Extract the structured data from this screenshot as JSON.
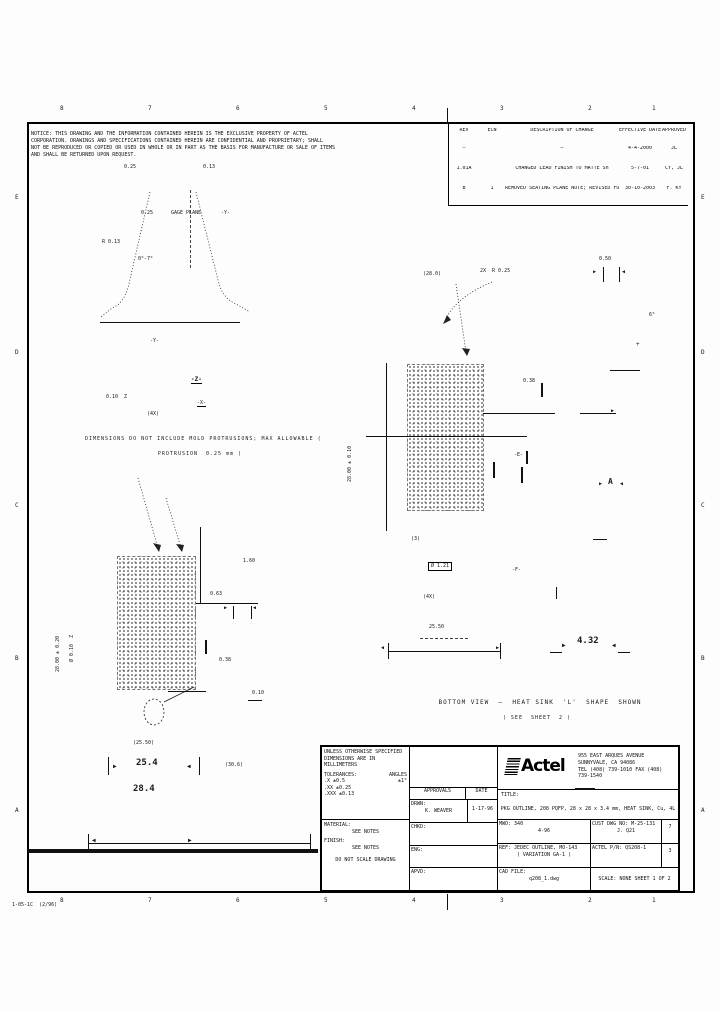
{
  "doc_number": "1-05-1C  (2/96)",
  "notes": {
    "lines": [
      "NOTICE: THIS DRAWING AND THE INFORMATION CONTAINED HEREIN IS THE EXCLUSIVE PROPERTY OF ACTEL",
      "CORPORATION. DRAWINGS AND SPECIFICATIONS CONTAINED HEREIN ARE CONFIDENTIAL AND PROPRIETARY; SHALL",
      "NOT BE REPRODUCED OR COPIED OR USED IN WHOLE OR IN PART AS THE BASIS FOR MANUFACTURE OR SALE OF ITEMS",
      "AND SHALL BE RETURNED UPON REQUEST."
    ]
  },
  "rev_table": {
    "headers": [
      "REV",
      "ECN",
      "DESCRIPTION OF CHANGE",
      "EFFECTIVE DATE",
      "APPROVED"
    ],
    "rows": [
      {
        "rev": "—",
        "ecn": "",
        "desc": "—",
        "date": "4-4-2000",
        "appr": "JL"
      },
      {
        "rev": "1.01A",
        "ecn": "",
        "desc": "CHANGED LEAD FINISH TO MATTE Sn",
        "date": "5-7-01",
        "appr": "CY, JL"
      },
      {
        "rev": "B",
        "ecn": "1",
        "desc": "REMOVED SEATING PLANE NOTE; REVISED FORMAT",
        "date": "30-10-2003",
        "appr": "F. KY"
      }
    ]
  },
  "title_block": {
    "tol": {
      "l1": "UNLESS OTHERWISE SPECIFIED",
      "l2": "DIMENSIONS ARE IN MILLIMETERS",
      "l3": "TOLERANCES:",
      "angles_label": "ANGLES",
      "angle_tol": "±1°",
      "r1": ".X      ±0.5",
      "r2": ".XX     ±0.25",
      "r3": ".XXX    ±0.13"
    },
    "material_label": "MATERIAL:",
    "material_value": "SEE NOTES",
    "finish_label": "FINISH:",
    "finish_value": "SEE NOTES",
    "no_scale": "DO NOT SCALE DRAWING",
    "approvals": {
      "header_left": "APPROVALS",
      "header_right": "DATE",
      "rows": [
        {
          "label": "DRWN:",
          "name": "K. WEAVER",
          "date": "1-17-96"
        },
        {
          "label": "CHKD:",
          "name": "",
          "date": ""
        },
        {
          "label": "ENG:",
          "name": "",
          "date": ""
        },
        {
          "label": "APVD:",
          "name": "",
          "date": ""
        }
      ]
    },
    "company": {
      "logo": "Actel",
      "addr1": "955 EAST ARQUES AVENUE",
      "addr2": "SUNNYVALE, CA 94086",
      "addr3": "TEL (408) 739-1010  FAX (408) 739-1540"
    },
    "title_label": "TITLE:",
    "title": "PKG OUTLINE, 208 PQFP, 28 x 28 x 3.4 mm, HEAT SINK, Cu, 4L",
    "grid": {
      "r1_left_label": "MWO: 340",
      "r1_left_value": "4-96",
      "r1_right": "CUST DWG NO: M-25-131",
      "r1_right_name": "J. Q21",
      "r1_rev": "7",
      "r2_left": "REF: JEDEC OUTLINE, MO-143",
      "r2_left_sub": "( VARIATION  GA-1 )",
      "r2_right": "ACTEL P/N: QS208-1",
      "r2_rev": "3",
      "r3_label": "CAD FILE:",
      "r3_value": "q208_1.dwg",
      "scale": "SCALE:  NONE        SHEET  1  OF  2"
    }
  },
  "annotations": [
    {
      "t": "8",
      "x": 60,
      "y": 106,
      "s": 6,
      "n": "zone-label"
    },
    {
      "t": "7",
      "x": 148,
      "y": 106,
      "s": 6,
      "n": "zone-label"
    },
    {
      "t": "6",
      "x": 236,
      "y": 106,
      "s": 6,
      "n": "zone-label"
    },
    {
      "t": "5",
      "x": 324,
      "y": 106,
      "s": 6,
      "n": "zone-label"
    },
    {
      "t": "4",
      "x": 412,
      "y": 106,
      "s": 6,
      "n": "zone-label"
    },
    {
      "t": "3",
      "x": 500,
      "y": 106,
      "s": 6,
      "n": "zone-label"
    },
    {
      "t": "2",
      "x": 588,
      "y": 106,
      "s": 6,
      "n": "zone-label"
    },
    {
      "t": "1",
      "x": 652,
      "y": 106,
      "s": 6,
      "n": "zone-label"
    },
    {
      "t": "8",
      "x": 60,
      "y": 898,
      "s": 6,
      "n": "zone-label"
    },
    {
      "t": "7",
      "x": 148,
      "y": 898,
      "s": 6,
      "n": "zone-label"
    },
    {
      "t": "6",
      "x": 236,
      "y": 898,
      "s": 6,
      "n": "zone-label"
    },
    {
      "t": "5",
      "x": 324,
      "y": 898,
      "s": 6,
      "n": "zone-label"
    },
    {
      "t": "4",
      "x": 412,
      "y": 898,
      "s": 6,
      "n": "zone-label"
    },
    {
      "t": "3",
      "x": 500,
      "y": 898,
      "s": 6,
      "n": "zone-label"
    },
    {
      "t": "2",
      "x": 588,
      "y": 898,
      "s": 6,
      "n": "zone-label"
    },
    {
      "t": "1",
      "x": 652,
      "y": 898,
      "s": 6,
      "n": "zone-label"
    },
    {
      "t": "E",
      "x": 15,
      "y": 195,
      "s": 6,
      "n": "zone-label"
    },
    {
      "t": "D",
      "x": 15,
      "y": 350,
      "s": 6,
      "n": "zone-label"
    },
    {
      "t": "C",
      "x": 15,
      "y": 503,
      "s": 6,
      "n": "zone-label"
    },
    {
      "t": "B",
      "x": 15,
      "y": 656,
      "s": 6,
      "n": "zone-label"
    },
    {
      "t": "A",
      "x": 15,
      "y": 808,
      "s": 6,
      "n": "zone-label"
    },
    {
      "t": "E",
      "x": 701,
      "y": 195,
      "s": 6,
      "n": "zone-label"
    },
    {
      "t": "D",
      "x": 701,
      "y": 350,
      "s": 6,
      "n": "zone-label"
    },
    {
      "t": "C",
      "x": 701,
      "y": 503,
      "s": 6,
      "n": "zone-label"
    },
    {
      "t": "B",
      "x": 701,
      "y": 656,
      "s": 6,
      "n": "zone-label"
    },
    {
      "t": "A",
      "x": 701,
      "y": 808,
      "s": 6,
      "n": "zone-label"
    },
    {
      "t": "1-05-1C  (2/96)",
      "x": 12,
      "y": 903,
      "s": 5,
      "n": "doc-number"
    },
    {
      "t": "0.25",
      "x": 124,
      "y": 165,
      "s": 5
    },
    {
      "t": "0.13",
      "x": 203,
      "y": 165,
      "s": 5
    },
    {
      "t": "R 0.13",
      "x": 102,
      "y": 240,
      "s": 5
    },
    {
      "t": "0.25",
      "x": 141,
      "y": 211,
      "s": 5
    },
    {
      "t": "GAGE PLANE",
      "x": 171,
      "y": 211,
      "s": 5
    },
    {
      "t": "-Y-",
      "x": 221,
      "y": 211,
      "s": 5
    },
    {
      "t": "0°-7°",
      "x": 138,
      "y": 257,
      "s": 5
    },
    {
      "t": "-Y-",
      "x": 150,
      "y": 339,
      "s": 5
    },
    {
      "t": "-Z-",
      "x": 191,
      "y": 377,
      "s": 6,
      "b": 1,
      "u": 1
    },
    {
      "t": "0.10  Z",
      "x": 106,
      "y": 395,
      "s": 5
    },
    {
      "t": "-X-",
      "x": 197,
      "y": 401,
      "s": 5,
      "u": 1
    },
    {
      "t": "(4X)",
      "x": 147,
      "y": 412,
      "s": 5
    },
    {
      "t": "DIMENSIONS DO NOT INCLUDE MOLD PROTRUSIONS; MAX ALLOWABLE (",
      "x": 85,
      "y": 437,
      "s": 5,
      "w": 230,
      "n": "view-caption"
    },
    {
      "t": "PROTRUSION  0.25 mm )",
      "x": 120,
      "y": 452,
      "s": 5,
      "w": 160,
      "n": "view-caption"
    },
    {
      "t": "0.63",
      "x": 210,
      "y": 592,
      "s": 5
    },
    {
      "t": "1.60",
      "x": 243,
      "y": 559,
      "s": 5
    },
    {
      "t": "▶",
      "x": 224,
      "y": 606,
      "s": 5
    },
    {
      "t": "◀",
      "x": 253,
      "y": 606,
      "s": 5
    },
    {
      "t": "0.38",
      "x": 219,
      "y": 658,
      "s": 5
    },
    {
      "t": "0.10",
      "x": 252,
      "y": 691,
      "s": 5
    },
    {
      "t": "28.00 ± 0.20",
      "x": 56,
      "y": 672,
      "s": 5,
      "r": -90
    },
    {
      "t": "Ø 0.10  Z",
      "x": 70,
      "y": 662,
      "s": 5,
      "r": -90
    },
    {
      "t": "(25.50)",
      "x": 133,
      "y": 741,
      "s": 5
    },
    {
      "t": "▶",
      "x": 113,
      "y": 764,
      "s": 6
    },
    {
      "t": "25.4",
      "x": 136,
      "y": 759,
      "s": 9,
      "b": 1
    },
    {
      "t": "◀",
      "x": 187,
      "y": 764,
      "s": 6
    },
    {
      "t": "28.4",
      "x": 133,
      "y": 785,
      "s": 9,
      "b": 1
    },
    {
      "t": "(30.6)",
      "x": 225,
      "y": 763,
      "s": 5
    },
    {
      "t": "◀",
      "x": 92,
      "y": 838,
      "s": 6
    },
    {
      "t": "▶",
      "x": 188,
      "y": 838,
      "s": 6
    },
    {
      "t": "(28.0)",
      "x": 423,
      "y": 272,
      "s": 5
    },
    {
      "t": "2X  R 0.25",
      "x": 480,
      "y": 269,
      "s": 5
    },
    {
      "t": "0.50",
      "x": 599,
      "y": 257,
      "s": 5
    },
    {
      "t": "▶",
      "x": 593,
      "y": 270,
      "s": 5
    },
    {
      "t": "◀",
      "x": 622,
      "y": 270,
      "s": 5
    },
    {
      "t": "+",
      "x": 636,
      "y": 342,
      "s": 6
    },
    {
      "t": "6°",
      "x": 649,
      "y": 313,
      "s": 5
    },
    {
      "t": "28.00 ± 0.10",
      "x": 348,
      "y": 482,
      "s": 5,
      "r": -90
    },
    {
      "t": "0.38",
      "x": 523,
      "y": 379,
      "s": 5
    },
    {
      "t": "-E-",
      "x": 514,
      "y": 453,
      "s": 5
    },
    {
      "t": "(3)",
      "x": 411,
      "y": 537,
      "s": 5
    },
    {
      "t": "Ø 1.21",
      "x": 428,
      "y": 562,
      "s": 5,
      "box": 1
    },
    {
      "t": "(4X)",
      "x": 423,
      "y": 595,
      "s": 5
    },
    {
      "t": "-F-",
      "x": 512,
      "y": 568,
      "s": 5
    },
    {
      "t": "25.50",
      "x": 429,
      "y": 625,
      "s": 5
    },
    {
      "t": "◀",
      "x": 381,
      "y": 646,
      "s": 5
    },
    {
      "t": "▶",
      "x": 496,
      "y": 646,
      "s": 5
    },
    {
      "t": "▶",
      "x": 562,
      "y": 643,
      "s": 6
    },
    {
      "t": "4.32",
      "x": 577,
      "y": 637,
      "s": 9,
      "b": 1
    },
    {
      "t": "◀",
      "x": 612,
      "y": 643,
      "s": 6
    },
    {
      "t": "A",
      "x": 608,
      "y": 478,
      "s": 8,
      "b": 1
    },
    {
      "t": "▶",
      "x": 599,
      "y": 482,
      "s": 5
    },
    {
      "t": "◀",
      "x": 620,
      "y": 482,
      "s": 5
    },
    {
      "t": "▶",
      "x": 611,
      "y": 409,
      "s": 5
    },
    {
      "t": "BOTTOM VIEW  —  HEAT SINK  'L'  SHAPE  SHOWN",
      "x": 435,
      "y": 700,
      "s": 6,
      "w": 210,
      "n": "view-caption"
    },
    {
      "t": "( SEE  SHEET  2 )",
      "x": 462,
      "y": 716,
      "s": 5,
      "w": 150,
      "n": "view-caption"
    }
  ],
  "graphics": {
    "lines": [
      {
        "x": 100,
        "y": 322,
        "w": 140,
        "h": 1
      },
      {
        "x": 190,
        "y": 190,
        "w": 1,
        "h": 78,
        "d": 1
      },
      {
        "x": 196,
        "y": 603,
        "w": 62,
        "h": 1
      },
      {
        "x": 200,
        "y": 527,
        "w": 1,
        "h": 76
      },
      {
        "x": 233,
        "y": 606,
        "w": 1,
        "h": 13
      },
      {
        "x": 251,
        "y": 606,
        "w": 1,
        "h": 13
      },
      {
        "x": 205,
        "y": 640,
        "w": 2,
        "h": 14
      },
      {
        "x": 168,
        "y": 691,
        "w": 38,
        "h": 1
      },
      {
        "x": 248,
        "y": 700,
        "w": 14,
        "h": 1
      },
      {
        "x": 108,
        "y": 757,
        "w": 1,
        "h": 18
      },
      {
        "x": 199,
        "y": 757,
        "w": 1,
        "h": 18
      },
      {
        "x": 88,
        "y": 843,
        "w": 222,
        "h": 1
      },
      {
        "x": 88,
        "y": 834,
        "w": 1,
        "h": 18
      },
      {
        "x": 310,
        "y": 834,
        "w": 1,
        "h": 18
      },
      {
        "x": 386,
        "y": 363,
        "w": 1,
        "h": 168
      },
      {
        "x": 366,
        "y": 436,
        "w": 161,
        "h": 1
      },
      {
        "x": 483,
        "y": 413,
        "w": 72,
        "h": 1
      },
      {
        "x": 541,
        "y": 383,
        "w": 2,
        "h": 14
      },
      {
        "x": 526,
        "y": 451,
        "w": 2,
        "h": 13
      },
      {
        "x": 493,
        "y": 462,
        "w": 2,
        "h": 16
      },
      {
        "x": 521,
        "y": 467,
        "w": 2,
        "h": 16
      },
      {
        "x": 420,
        "y": 638,
        "w": 48,
        "h": 1,
        "d": 1
      },
      {
        "x": 388,
        "y": 651,
        "w": 112,
        "h": 1
      },
      {
        "x": 388,
        "y": 643,
        "w": 1,
        "h": 16
      },
      {
        "x": 500,
        "y": 643,
        "w": 1,
        "h": 16
      },
      {
        "x": 556,
        "y": 587,
        "w": 1,
        "h": 12
      },
      {
        "x": 593,
        "y": 539,
        "w": 14,
        "h": 1
      },
      {
        "x": 550,
        "y": 652,
        "w": 12,
        "h": 1
      },
      {
        "x": 618,
        "y": 652,
        "w": 12,
        "h": 1
      },
      {
        "x": 610,
        "y": 370,
        "w": 30,
        "h": 1
      },
      {
        "x": 580,
        "y": 413,
        "w": 36,
        "h": 1
      },
      {
        "x": 603,
        "y": 267,
        "w": 1,
        "h": 15
      },
      {
        "x": 619,
        "y": 267,
        "w": 1,
        "h": 15
      },
      {
        "x": 28,
        "y": 849,
        "w": 290,
        "h": 4
      },
      {
        "x": 447,
        "y": 108,
        "w": 1,
        "h": 16
      },
      {
        "x": 447,
        "y": 894,
        "w": 1,
        "h": 16
      },
      {
        "x": 575,
        "y": 788,
        "w": 20,
        "h": 2
      }
    ]
  }
}
